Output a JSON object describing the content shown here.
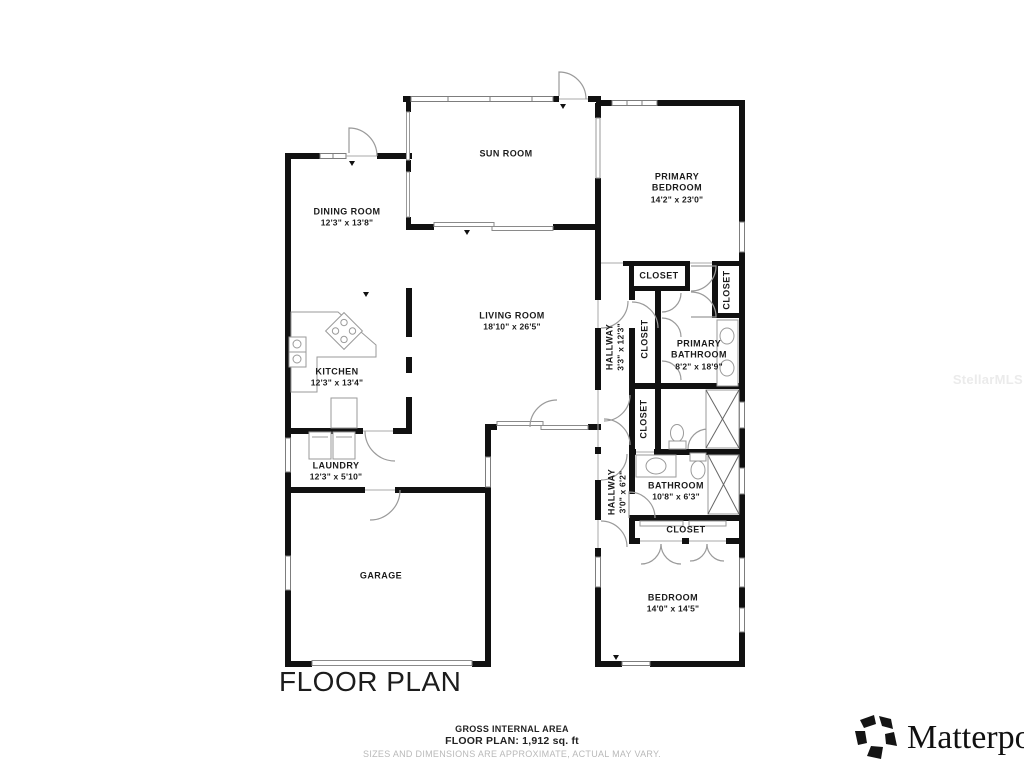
{
  "title": "FLOOR PLAN",
  "watermark": "StellarMLS",
  "brand": {
    "name": "Matterport"
  },
  "footer": {
    "line1": "GROSS INTERNAL AREA",
    "line2": "FLOOR PLAN: 1,912 sq. ft",
    "line3": "SIZES AND DIMENSIONS ARE APPROXIMATE, ACTUAL MAY VARY."
  },
  "colors": {
    "wall": "#111111",
    "door_line": "#9a9a9a",
    "label_text": "#1b1b1b",
    "muted_text": "#b9b9b9"
  },
  "gross_internal_area_sqft": "1,912",
  "rooms": [
    {
      "id": "sun-room",
      "name": "SUN ROOM",
      "dims": ""
    },
    {
      "id": "primary-bedroom",
      "name": "PRIMARY\nBEDROOM",
      "dims": "14'2\" x 23'0\""
    },
    {
      "id": "dining-room",
      "name": "DINING ROOM",
      "dims": "12'3\" x 13'8\""
    },
    {
      "id": "living-room",
      "name": "LIVING ROOM",
      "dims": "18'10\" x 26'5\""
    },
    {
      "id": "kitchen",
      "name": "KITCHEN",
      "dims": "12'3\" x 13'4\""
    },
    {
      "id": "laundry",
      "name": "LAUNDRY",
      "dims": "12'3\" x 5'10\""
    },
    {
      "id": "garage",
      "name": "GARAGE",
      "dims": ""
    },
    {
      "id": "hallway-upper",
      "name": "HALLWAY",
      "dims": "3'3\" x 12'3\""
    },
    {
      "id": "closet-1",
      "name": "CLOSET",
      "dims": ""
    },
    {
      "id": "closet-2",
      "name": "CLOSET",
      "dims": ""
    },
    {
      "id": "primary-bathroom",
      "name": "PRIMARY\nBATHROOM",
      "dims": "8'2\" x 18'9\""
    },
    {
      "id": "closet-3",
      "name": "CLOSET",
      "dims": ""
    },
    {
      "id": "closet-4",
      "name": "CLOSET",
      "dims": ""
    },
    {
      "id": "hallway-lower",
      "name": "HALLWAY",
      "dims": "3'0\" x 6'2\""
    },
    {
      "id": "bathroom",
      "name": "BATHROOM",
      "dims": "10'8\" x 6'3\""
    },
    {
      "id": "closet-5",
      "name": "CLOSET",
      "dims": ""
    },
    {
      "id": "bedroom",
      "name": "BEDROOM",
      "dims": "14'0\" x 14'5\""
    }
  ]
}
